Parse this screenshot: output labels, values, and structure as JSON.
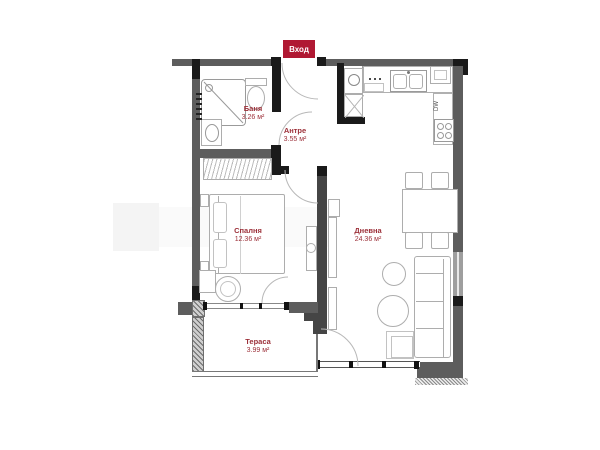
{
  "plan": {
    "entrance_label": "Вход",
    "rooms": {
      "bathroom": {
        "name": "Баня",
        "area": "3.26 м²"
      },
      "hallway": {
        "name": "Антре",
        "area": "3.55 м²"
      },
      "bedroom": {
        "name": "Спалня",
        "area": "12.36 м²"
      },
      "living": {
        "name": "Дневна",
        "area": "24.36 м²"
      },
      "terrace": {
        "name": "Тераса",
        "area": "3.99 м²"
      }
    },
    "appliances": {
      "dishwasher_label": "DW"
    },
    "colors": {
      "accent_red": "#b01933",
      "label_red": "#9c2f38",
      "wall_gray": "#5d5d5d",
      "wall_black": "#1a1a1a",
      "furniture_line": "#adadad"
    }
  }
}
